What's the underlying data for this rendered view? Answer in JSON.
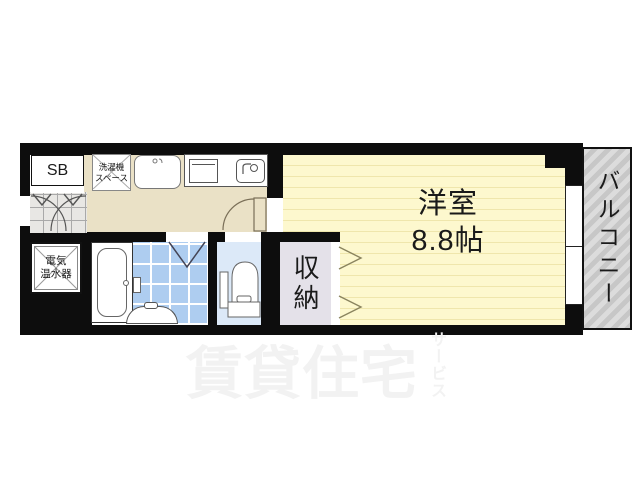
{
  "rooms": {
    "main_room": {
      "name": "洋室",
      "size": "8.8帖"
    },
    "balcony": {
      "label": "バルコニー"
    },
    "storage": {
      "label": "収納"
    },
    "shoe_box": {
      "label": "SB"
    },
    "washer_space": {
      "line1": "洗濯機",
      "line2": "スペース"
    },
    "water_heater": {
      "line1": "電気",
      "line2": "温水器"
    }
  },
  "watermark": {
    "main": "賃貸住宅",
    "sub": "サービス"
  },
  "colors": {
    "wall": "#0d0d0d",
    "room_floor": "#fdf8ce",
    "room_stripe": "#efe6ac",
    "hallway_floor": "#eae1c6",
    "bathroom_tile": "#aecdf0",
    "toilet_floor": "#dce9f8",
    "closet_floor": "#e4e1e9",
    "entrance_tile": "#e8e7e4",
    "balcony_light": "#dcdcdc",
    "balcony_dark": "#c7c7c7",
    "watermark": "#f2f2f2"
  }
}
